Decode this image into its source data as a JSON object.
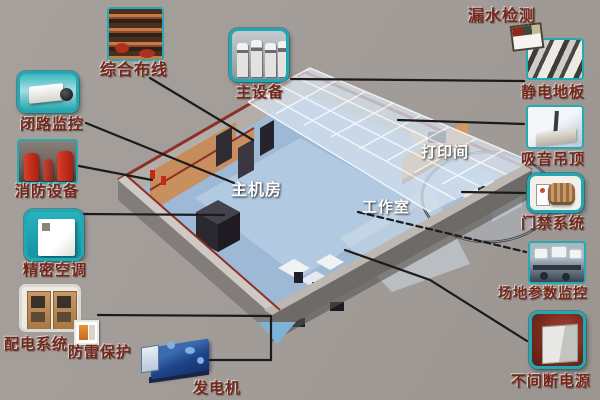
{
  "scene": {
    "background": "#a29c98",
    "accent_teal": "#1fa9b4",
    "label_color": "#73281e",
    "line_color": "#1b1b1b",
    "floor_color": "#9db9d6",
    "wall_color": "#8b8683",
    "trim_color": "#8e3028"
  },
  "callouts": [
    {
      "id": "integrated-cabling",
      "label": "综合布线"
    },
    {
      "id": "cctv-monitoring",
      "label": "闭路监控"
    },
    {
      "id": "fire-equipment",
      "label": "消防设备"
    },
    {
      "id": "precision-ac",
      "label": "精密空调"
    },
    {
      "id": "power-distribution",
      "label": "配电系统"
    },
    {
      "id": "lightning-protection",
      "label": "防雷保护"
    },
    {
      "id": "generator",
      "label": "发电机"
    },
    {
      "id": "main-equipment",
      "label": "主设备"
    },
    {
      "id": "leak-detection",
      "label": "漏水检测"
    },
    {
      "id": "antistatic-floor",
      "label": "静电地板"
    },
    {
      "id": "acoustic-ceiling",
      "label": "吸音吊顶"
    },
    {
      "id": "access-control",
      "label": "门禁系统"
    },
    {
      "id": "site-monitoring",
      "label": "场地参数监控"
    },
    {
      "id": "ups",
      "label": "不间断电源"
    }
  ],
  "rooms": [
    {
      "id": "main-machine-room",
      "label": "主机房"
    },
    {
      "id": "work-room",
      "label": "工作室"
    },
    {
      "id": "print-room",
      "label": "打印间"
    }
  ]
}
